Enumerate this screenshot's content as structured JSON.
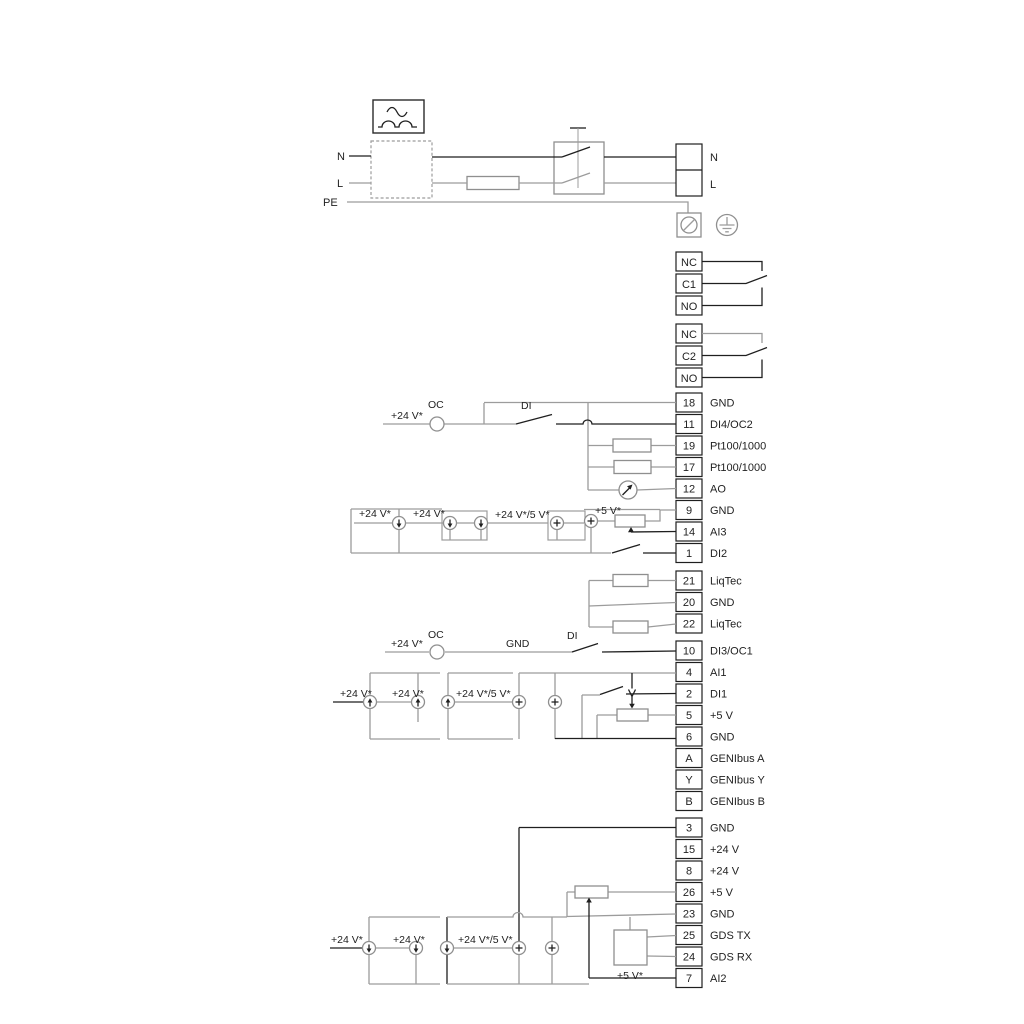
{
  "labels": {
    "v24": "+24 V*",
    "v24v5": "+24 V*/5 V*",
    "v5": "+5 V*",
    "oc": "OC",
    "di": "DI",
    "gnd": "GND"
  },
  "power": {
    "in": {
      "n": "N",
      "l": "L",
      "pe": "PE"
    },
    "out": {
      "n": "N",
      "l": "L"
    }
  },
  "relay1": [
    "NC",
    "C1",
    "NO"
  ],
  "relay2": [
    "NC",
    "C2",
    "NO"
  ],
  "io1": [
    {
      "n": "18",
      "l": "GND"
    },
    {
      "n": "11",
      "l": "DI4/OC2"
    },
    {
      "n": "19",
      "l": "Pt100/1000"
    },
    {
      "n": "17",
      "l": "Pt100/1000"
    },
    {
      "n": "12",
      "l": "AO"
    },
    {
      "n": "9",
      "l": "GND"
    },
    {
      "n": "14",
      "l": "AI3"
    },
    {
      "n": "1",
      "l": "DI2"
    }
  ],
  "liqtec": [
    {
      "n": "21",
      "l": "LiqTec"
    },
    {
      "n": "20",
      "l": "GND"
    },
    {
      "n": "22",
      "l": "LiqTec"
    }
  ],
  "io2": [
    {
      "n": "10",
      "l": "DI3/OC1"
    },
    {
      "n": "4",
      "l": "AI1"
    },
    {
      "n": "2",
      "l": "DI1"
    },
    {
      "n": "5",
      "l": "+5 V"
    },
    {
      "n": "6",
      "l": "GND"
    },
    {
      "n": "A",
      "l": "GENIbus A"
    },
    {
      "n": "Y",
      "l": "GENIbus Y"
    },
    {
      "n": "B",
      "l": "GENIbus B"
    }
  ],
  "io3": [
    {
      "n": "3",
      "l": "GND"
    },
    {
      "n": "15",
      "l": "+24 V"
    },
    {
      "n": "8",
      "l": "+24 V"
    },
    {
      "n": "26",
      "l": "+5 V"
    },
    {
      "n": "23",
      "l": "GND"
    },
    {
      "n": "25",
      "l": "GDS TX"
    },
    {
      "n": "24",
      "l": "GDS RX"
    },
    {
      "n": "7",
      "l": "AI2"
    }
  ]
}
